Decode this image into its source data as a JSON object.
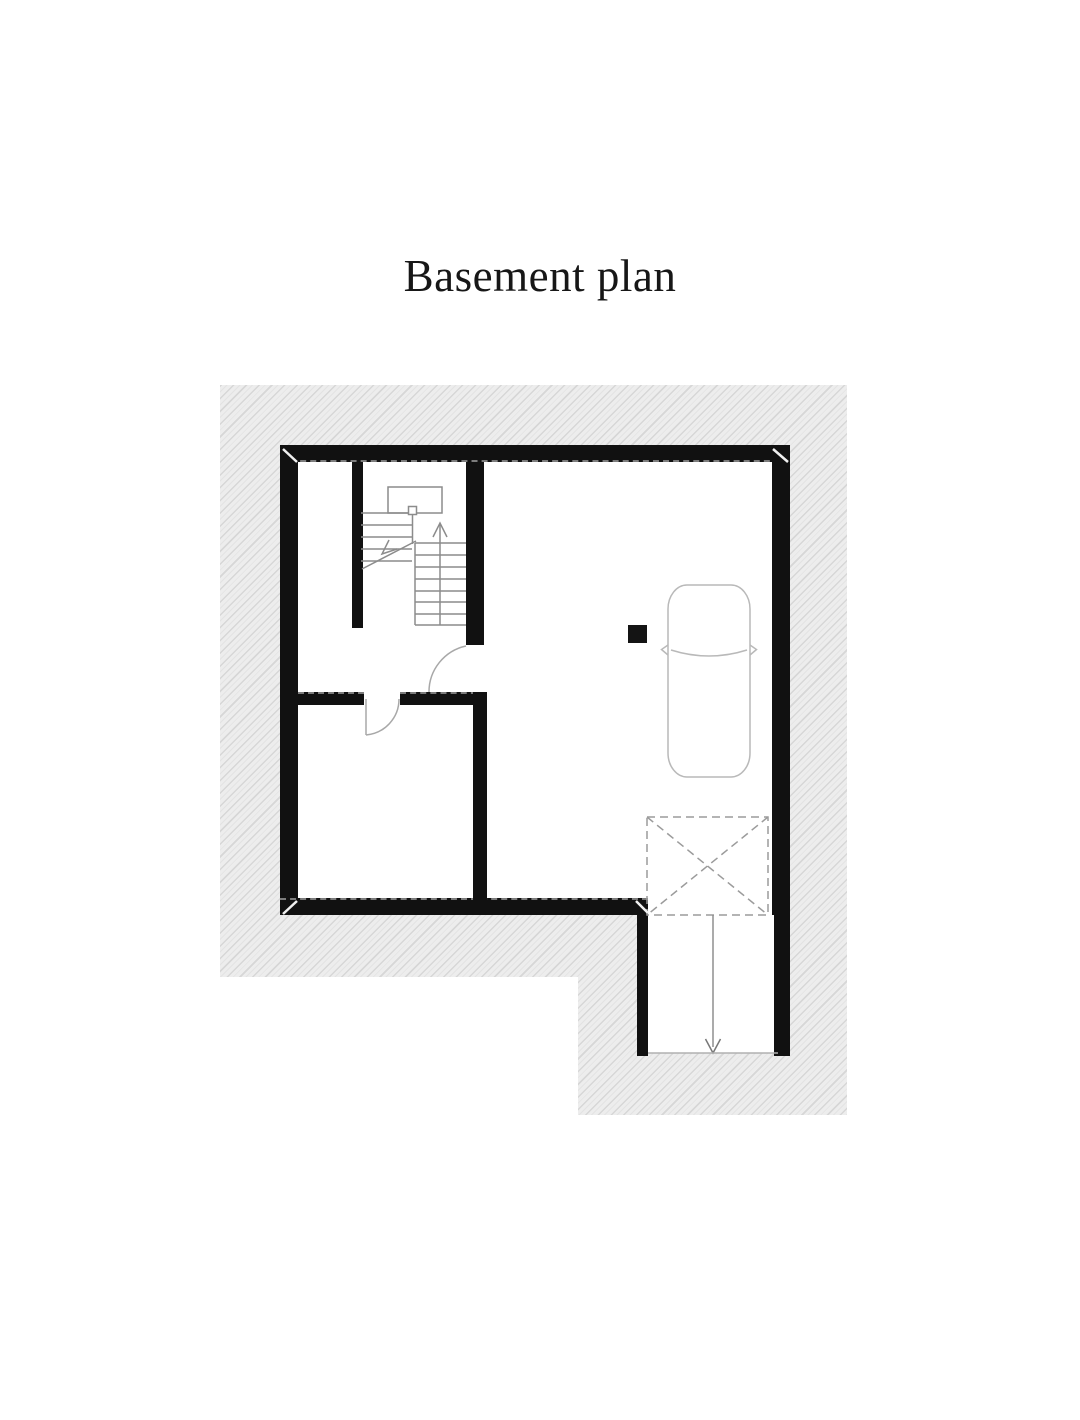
{
  "page": {
    "title": "Basement plan"
  },
  "plan": {
    "type": "floor-plan-drawing",
    "symbols": [
      "staircase",
      "door-swing-hall",
      "door-swing-storage",
      "car-symbol",
      "column-marker",
      "garage-door-marker",
      "ramp-direction-arrow"
    ],
    "colors": {
      "paper": "#ffffff",
      "wall": "#111111",
      "hatch_background": "#ededed",
      "hatch_line": "#d7d7d7",
      "linework": "#8c8c8c",
      "car_outline": "#b9b9b9",
      "dashed_marker": "#9b9b9b"
    }
  }
}
